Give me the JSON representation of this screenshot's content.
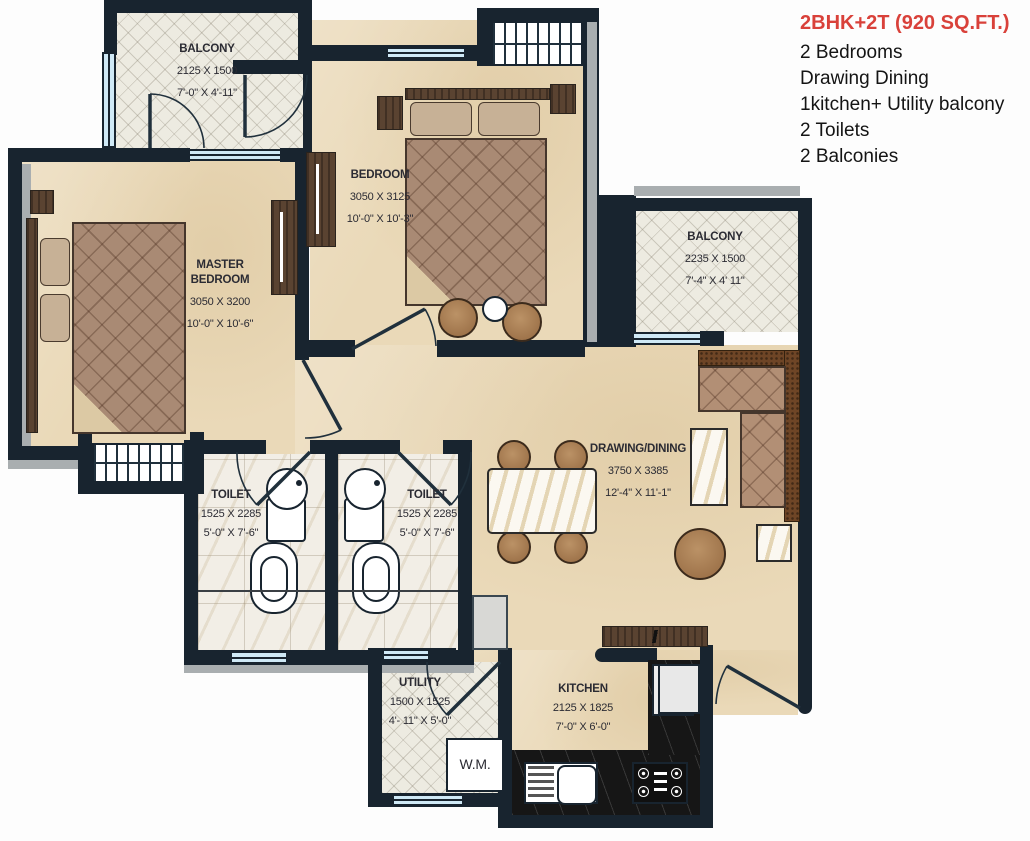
{
  "legend": {
    "title": "2BHK+2T (920 SQ.FT.)",
    "title_color": "#d9413a",
    "items": [
      "2 Bedrooms",
      "Drawing Dining",
      "1kitchen+ Utility balcony",
      "2 Toilets",
      "2 Balconies"
    ]
  },
  "rooms": {
    "balcony_top_left": {
      "name": "BALCONY",
      "dim_mm": "2125 X 1500",
      "dim_ft": "7'-0\" X 4'-11\""
    },
    "bedroom": {
      "name": "BEDROOM",
      "dim_mm": "3050 X 3125",
      "dim_ft": "10'-0\" X 10'-3\""
    },
    "master_bedroom": {
      "name": "MASTER BEDROOM",
      "dim_mm": "3050 X 3200",
      "dim_ft": "10'-0\" X 10'-6\""
    },
    "balcony_right": {
      "name": "BALCONY",
      "dim_mm": "2235 X 1500",
      "dim_ft": "7'-4\" X 4' 11\""
    },
    "drawing_dining": {
      "name": "DRAWING/DINING",
      "dim_mm": "3750 X 3385",
      "dim_ft": "12'-4\" X 11'-1\""
    },
    "toilet_left": {
      "name": "TOILET",
      "dim_mm": "1525 X 2285",
      "dim_ft": "5'-0\" X 7'-6\""
    },
    "toilet_right": {
      "name": "TOILET",
      "dim_mm": "1525 X 2285",
      "dim_ft": "5'-0\" X 7'-6\""
    },
    "utility": {
      "name": "UTILITY",
      "dim_mm": "1500 X 1525",
      "dim_ft": "4'- 11\" X 5'-0\""
    },
    "kitchen": {
      "name": "KITCHEN",
      "dim_mm": "2125 X 1825",
      "dim_ft": "7'-0\" X 6'-0\""
    }
  },
  "fixtures": {
    "washing_machine_label": "W.M."
  },
  "colors": {
    "wall": "#18242f",
    "floor": "#ead9b8",
    "window_glass": "#cfe9f6",
    "title_red": "#d9413a"
  }
}
